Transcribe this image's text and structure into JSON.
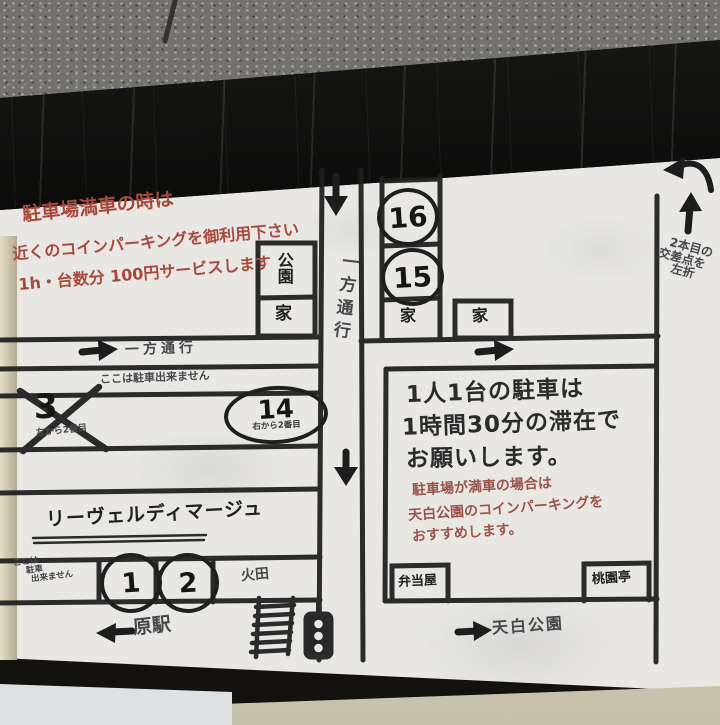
{
  "colors": {
    "marker_black": "#202020",
    "marker_red": "#a8493d",
    "note_red": "#9a544a",
    "board_white": "#e8e7e3",
    "frame_black": "#0b0b0b",
    "wood_beige": "#cfc7ae"
  },
  "icons": {
    "arrow_down": "↓",
    "arrow_up": "↑",
    "arrow_left": "←",
    "arrow_right": "→",
    "curved_left_arrow": "↰",
    "traffic_light": "🚦",
    "crosswalk": "ladder-shape",
    "cross_out_x": "✕"
  },
  "board": {
    "red_notice": [
      "駐車場満車の時は",
      "近くのコインパーキングを御利用下さい",
      "1h・台数分 100円サービスします"
    ],
    "one_way_center": "一方通行",
    "one_way_left": "一方通行",
    "park_label": "公園",
    "house_label_1": "家",
    "house_label_2": "家",
    "house_label_3": "家",
    "spot_16": "16",
    "spot_15": "15",
    "no_parking_here": "ここは駐車出来ません",
    "spot_3": {
      "number": "3",
      "note": "左から2番目"
    },
    "spot_14": {
      "number": "14",
      "note": "右から2番目"
    },
    "shop_name": "リーヴェルディマージュ",
    "spot_1": "1",
    "spot_2": "2",
    "no_parking_small": [
      "ここは",
      "駐車",
      "出来ません"
    ],
    "field_label": "火田",
    "station_label": "原駅",
    "parking_rule": [
      "1人1台の駐車は",
      "1時間30分の滞在で",
      "お願いします。"
    ],
    "full_note": [
      "駐車場が満車の場合は",
      "天白公園のコインパーキングを",
      "おすすめします。"
    ],
    "bento_label": "弁当屋",
    "restaurant_label": "桃園亭",
    "park_direction_label": "天白公園",
    "turn_instruction": [
      "2本目の",
      "交差点を",
      "左折"
    ]
  }
}
